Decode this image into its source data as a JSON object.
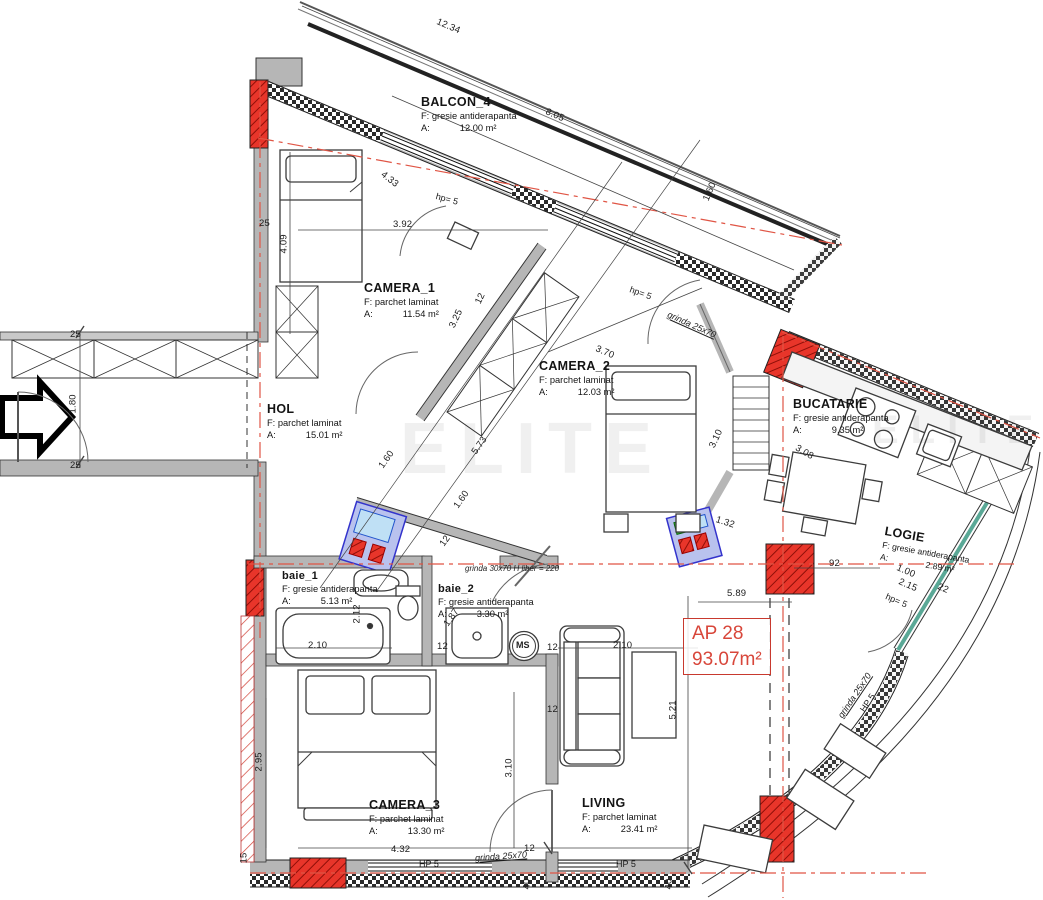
{
  "apartment_label": {
    "id": "AP 28",
    "area": "93.07m²"
  },
  "rooms": [
    {
      "name": "BALCON_4",
      "floor": "F: gresie antiderapanta",
      "area_prefix": "A:",
      "area": "12.00 m²"
    },
    {
      "name": "CAMERA_1",
      "floor": "F: parchet laminat",
      "area_prefix": "A:",
      "area": "11.54 m²"
    },
    {
      "name": "CAMERA_2",
      "floor": "F: parchet laminat",
      "area_prefix": "A:",
      "area": "12.03 m²"
    },
    {
      "name": "HOL",
      "floor": "F: parchet laminat",
      "area_prefix": "A:",
      "area": "15.01 m²"
    },
    {
      "name": "BUCATARIE",
      "floor": "F: gresie antiderapanta",
      "area_prefix": "A:",
      "area": "9.35 m²"
    },
    {
      "name": "LOGIE",
      "floor": "F: gresie antiderapanta",
      "area_prefix": "A:",
      "area": "2.89 m²"
    },
    {
      "name": "baie_1",
      "floor": "F: gresie antiderapanta",
      "area_prefix": "A:",
      "area": "5.13 m²"
    },
    {
      "name": "baie_2",
      "floor": "F: gresie antiderapanta",
      "area_prefix": "A:",
      "area": "3.30 m²"
    },
    {
      "name": "CAMERA_3",
      "floor": "F: parchet laminat",
      "area_prefix": "A:",
      "area": "13.30 m²"
    },
    {
      "name": "LIVING",
      "floor": "F: parchet laminat",
      "area_prefix": "A:",
      "area": "23.41 m²"
    }
  ],
  "dims": [
    "12.34",
    "8.05",
    "1.60",
    "4.33",
    "3.92",
    "4.09",
    "25",
    "25",
    "1.80",
    "25",
    "3.25",
    "12",
    "3.70",
    "1.60",
    "5.73",
    "1.60",
    "12",
    "3.10",
    "3.08",
    "1.32",
    "92",
    "5.89",
    "1.00",
    "2.15",
    "22",
    "2.12",
    "2.10",
    "12",
    "1.87",
    "2.10",
    "5.21",
    "12",
    "12",
    "3.10",
    "2.95",
    "4.32",
    "12",
    "40",
    "40",
    "15"
  ],
  "notes": [
    "hp= 5",
    "hp= 5",
    "grinda 25x70",
    "grinda 30x70 H liber = 220",
    "HP 5",
    "grinda 25x70",
    "HP 5",
    "grinda 25x70",
    "HP 5",
    "hp= 5"
  ],
  "labels": {
    "washing_machine": "MS"
  },
  "watermark": "ELITE",
  "colors": {
    "wall_gray": "#b6b6b6",
    "column_red": "#e8352a",
    "axis_red": "#e05545",
    "label_red": "#d8463a",
    "glazing_teal": "#5aa896",
    "shaft_blue": "#3333cc",
    "shaft_fill": "#b9c2ee"
  }
}
